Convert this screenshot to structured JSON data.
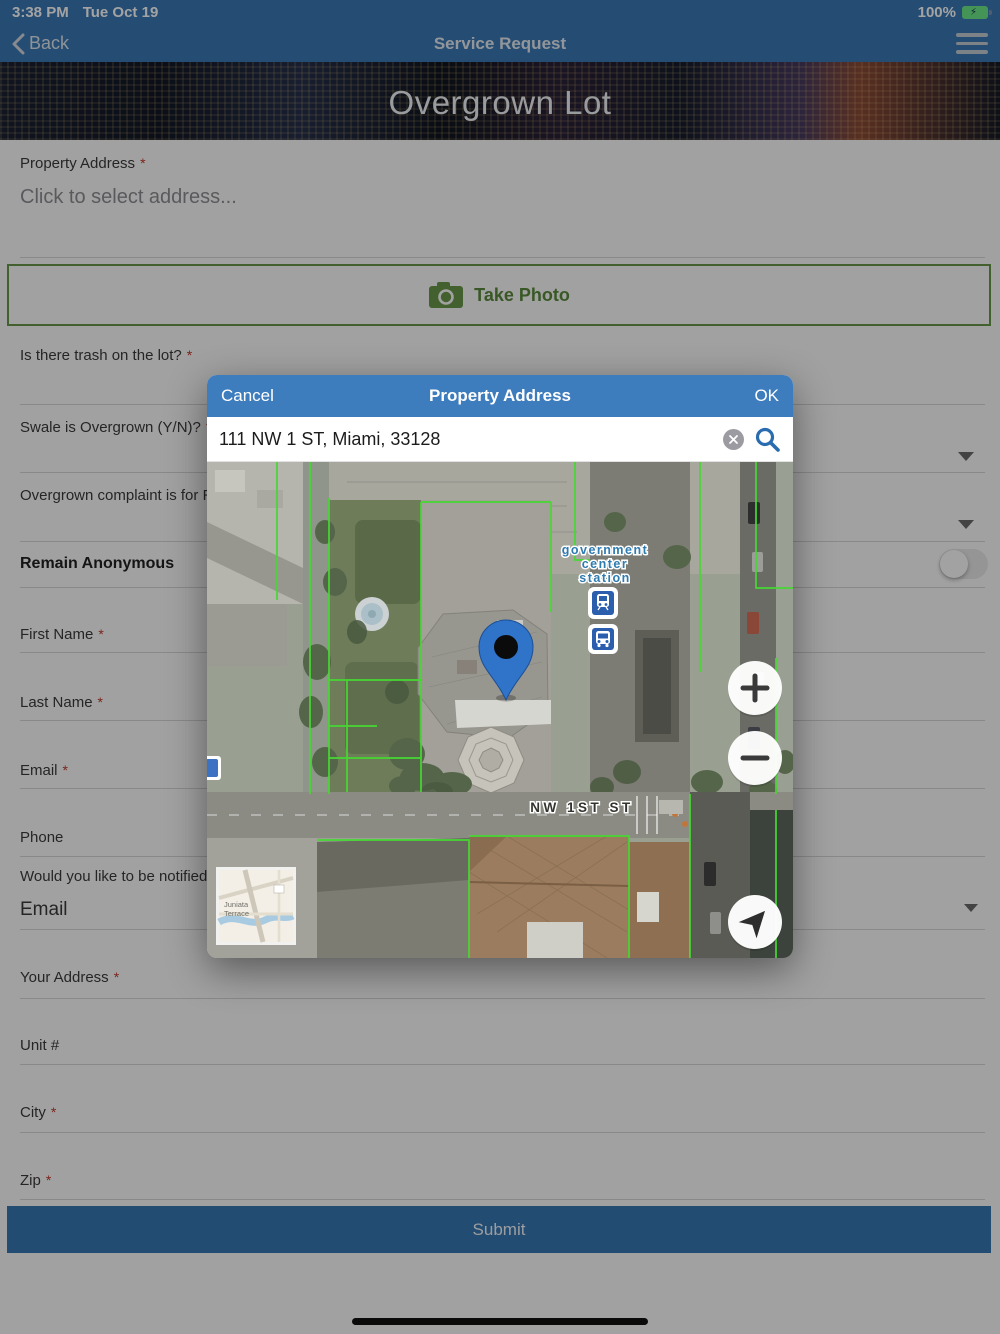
{
  "status_bar": {
    "time": "3:38 PM",
    "date": "Tue Oct 19",
    "battery_percent": "100%"
  },
  "nav_bar": {
    "back_label": "Back",
    "title": "Service Request"
  },
  "hero": {
    "title": "Overgrown Lot"
  },
  "form": {
    "required_marker": "*",
    "property_address": {
      "label": "Property Address",
      "placeholder": "Click to select address..."
    },
    "take_photo_label": "Take Photo",
    "trash_label": "Is there trash on the lot?",
    "swale_label": "Swale is Overgrown (Y/N)?",
    "overgrown_for_label": "Overgrown complaint is for Rig",
    "anonymous_label": "Remain Anonymous",
    "first_name_label": "First Name",
    "last_name_label": "Last Name",
    "email_label": "Email",
    "phone_label": "Phone",
    "notify_label": "Would you like to be notified o",
    "notify_value": "Email",
    "your_address_label": "Your Address",
    "unit_label": "Unit #",
    "city_label": "City",
    "zip_label": "Zip",
    "submit_label": "Submit"
  },
  "modal": {
    "cancel_label": "Cancel",
    "title": "Property Address",
    "ok_label": "OK",
    "search_value": "111 NW 1 ST, Miami, 33128",
    "map": {
      "station_lines": [
        "government",
        "center",
        "station"
      ],
      "street_label": "NW 1ST ST",
      "mini_map_lines": [
        "Juniata",
        "Terrace"
      ]
    }
  },
  "icons": {
    "back": "chevron-left",
    "menu": "hamburger",
    "camera": "camera",
    "dropdown": "chevron-down",
    "toggle": "switch-off",
    "clear": "circle-x",
    "search": "magnifier",
    "pin": "map-pin",
    "train": "train-station",
    "bus": "bus-station",
    "zoom_in": "plus",
    "zoom_out": "minus",
    "locate": "navigation-arrow",
    "battery": "battery-charging",
    "home": "home-indicator"
  },
  "colors": {
    "nav_blue": "#3a78b5",
    "modal_blue": "#3d7cbd",
    "accent_green": "#68984a",
    "parcel_green": "#46d832",
    "pin_blue": "#2f74c8",
    "submit_blue": "#3877b2"
  }
}
